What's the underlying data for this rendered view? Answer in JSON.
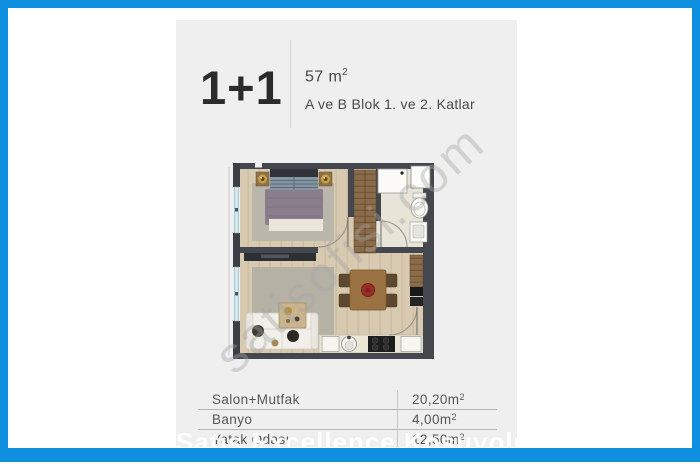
{
  "page": {
    "frame_color": "#0e8fdf",
    "panel_bg": "#efeff0"
  },
  "header": {
    "plan_type": "1+1",
    "area_value": "57 m",
    "area_sup": "2",
    "block_info": "A ve B Blok 1. ve 2. Katlar"
  },
  "table": {
    "rows": [
      {
        "label": "Salon+Mutfak",
        "value": "20,20m",
        "sup": "2"
      },
      {
        "label": "Banyo",
        "value": "4,00m",
        "sup": "2"
      },
      {
        "label": "Yatak Odası",
        "value": "12,50m",
        "sup": "2"
      }
    ]
  },
  "watermarks": {
    "diagonal": "satisofisi.com",
    "bottom": "Satış Excellence Koşuyolu"
  }
}
